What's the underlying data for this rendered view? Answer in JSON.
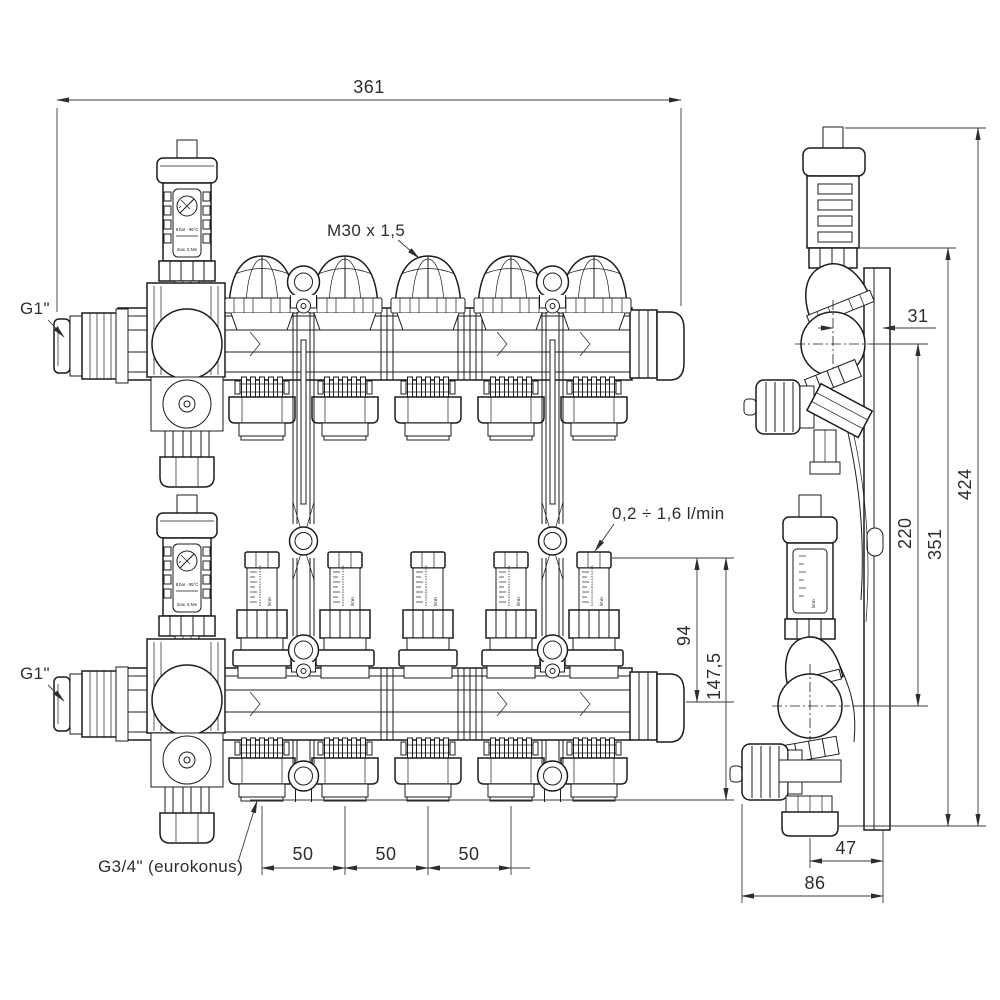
{
  "drawing": {
    "background": "#ffffff",
    "line_color": "#1c1c1c",
    "views": [
      "front-view-supply-manifold",
      "front-view-return-manifold",
      "side-view"
    ]
  },
  "labels": {
    "valve_thread": "M30 x 1,5",
    "main_connection_top": "G1\"",
    "main_connection_bottom": "G1\"",
    "flow_range": "0,2 ÷ 1,6 l/min",
    "outlet_thread": "G3/4\" (eurokonus)",
    "vent_rating": "8 bar - 95°C",
    "vent_torque": "max. 5 Nm",
    "flow_unit": "l/min",
    "flow_scale": "0,2 0,4 0,6 0,8 1,0 1,2 1,4 1,6"
  },
  "dimensions": {
    "total_length": "361",
    "spacing_a": "50",
    "spacing_b": "50",
    "spacing_c": "50",
    "flowmeter_height": "94",
    "valve_assembly_height": "147,5",
    "pipe_axis_offset": "31",
    "axis_distance": "220",
    "bracket_height": "351",
    "total_height": "424",
    "outlet_depth": "47",
    "total_depth": "86"
  }
}
